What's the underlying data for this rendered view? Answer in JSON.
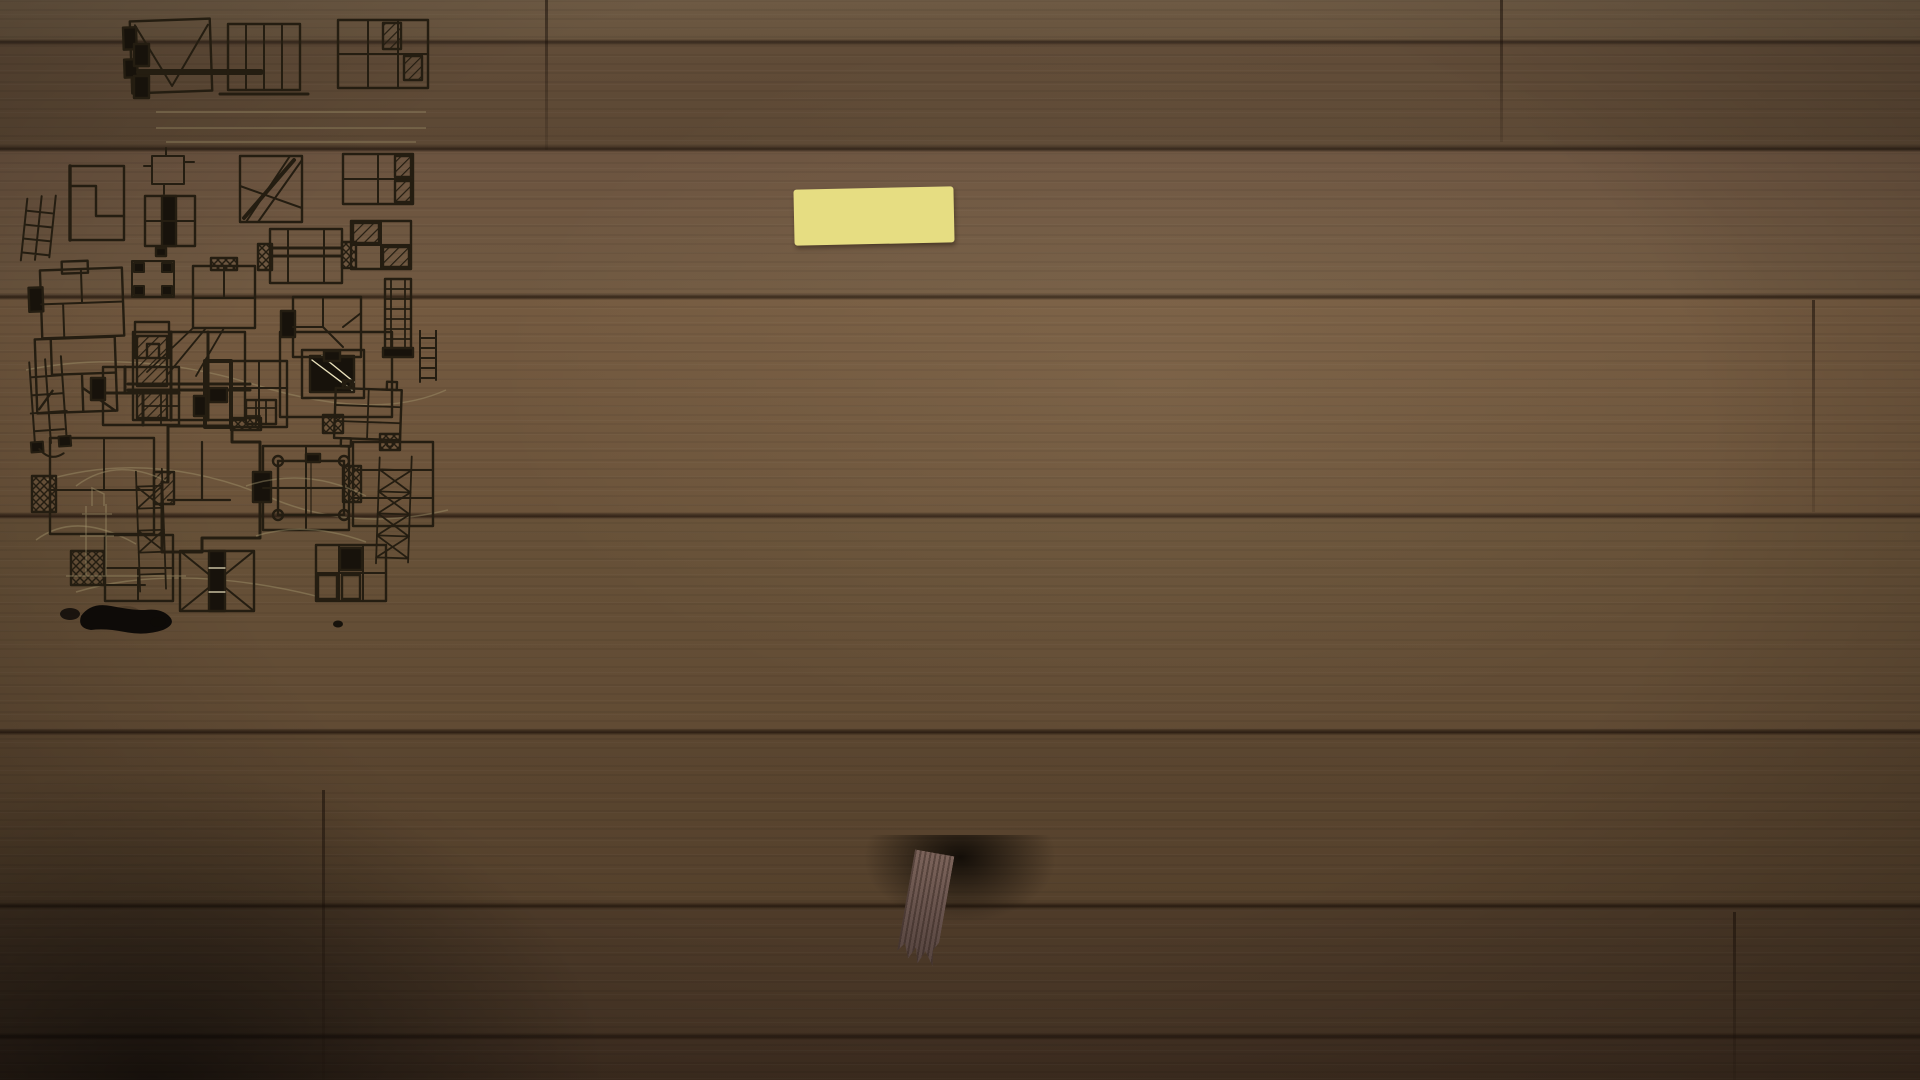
{
  "scene": {
    "description": "Open architect's sketchbook with ink plan sketches and yellow sticky notes on a dark wooden table",
    "colors": {
      "wood": "#5d4731",
      "wood_shadow": "#241a10",
      "paper": "#ede3bf",
      "ink": "#211a0e",
      "pencil": "#a2946c",
      "sticky_yellow": "#e9e187",
      "sticky_fold": "#f2ecaa",
      "ribbon": "#6f5a52",
      "strap": "#12100d"
    }
  },
  "left_page": {
    "date": "150419_",
    "title": "BRUNO",
    "tilde_1": "~",
    "box_pres_tower": "pres. Tower",
    "tilde_2": "~",
    "box_mexic": "Mexic plate",
    "arrow_down": "↓",
    "tower_date": "150419_",
    "tower_title": "TOWER",
    "check": "✓",
    "crossed_out": [
      "JOHN",
      "MAX",
      "IMPRESS TOWER"
    ],
    "side_note_1": "lets make plans + study",
    "side_note_2": "sketch sections · top view each plan",
    "blob_boxes": [
      "BLOB",
      "AND",
      "CARRY"
    ],
    "blob_arrow": "⇒ ALL OPTIONS",
    "paragraph_line1": "but you can have vivid articulation by staying in the",
    "paragraph_line2": "boundary . . . . .",
    "big_box": "Shivacion",
    "silhouette": "silhouette",
    "blob_quote": "“Blob”",
    "stack": "stack",
    "organhaus": "organhaus",
    "vertical": "vertical",
    "parking": "parking",
    "typologies": "tower typologies ?",
    "area": "50 m²"
  },
  "right_page": {
    "label_periphery": "periphery",
    "label_core": "core",
    "label_column_free": "column free",
    "label_plan_libre": "plan libre"
  },
  "sticky_note": {
    "faint_text": "zon / core"
  }
}
